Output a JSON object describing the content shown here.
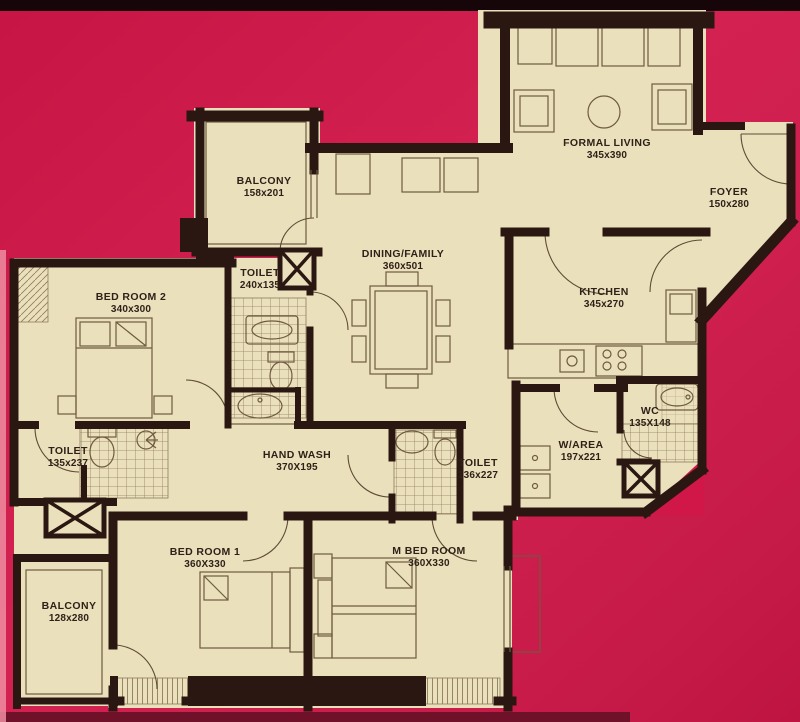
{
  "title": "apartment-floor-plan",
  "colors": {
    "background": "#d11648",
    "top_band": "#16060a",
    "bottom_band": "#6e1129",
    "left_edge_strip": "#ef8da1",
    "floor": "#ebe0bc",
    "wall": "#2a1711",
    "furniture_line": "#6e5b40",
    "label_text": "#2f2118"
  },
  "rooms": [
    {
      "id": "balcony-top",
      "name": "BALCONY",
      "dims": "158x201"
    },
    {
      "id": "formal-living",
      "name": "FORMAL LIVING",
      "dims": "345x390"
    },
    {
      "id": "foyer",
      "name": "FOYER",
      "dims": "150x280"
    },
    {
      "id": "dining-family",
      "name": "DINING/FAMILY",
      "dims": "360x501"
    },
    {
      "id": "kitchen",
      "name": "KITCHEN",
      "dims": "345x270"
    },
    {
      "id": "bed-room-2",
      "name": "BED ROOM 2",
      "dims": "340x300"
    },
    {
      "id": "toilet-top",
      "name": "TOILET",
      "dims": "240x135"
    },
    {
      "id": "toilet-left",
      "name": "TOILET",
      "dims": "135x237"
    },
    {
      "id": "hand-wash",
      "name": "HAND WASH",
      "dims": "370X195"
    },
    {
      "id": "toilet-mid",
      "name": "TOILET",
      "dims": "136x227"
    },
    {
      "id": "w-area",
      "name": "W/AREA",
      "dims": "197x221"
    },
    {
      "id": "wc",
      "name": "WC",
      "dims": "135X148"
    },
    {
      "id": "bed-room-1",
      "name": "BED ROOM 1",
      "dims": "360X330"
    },
    {
      "id": "m-bed-room",
      "name": "M BED ROOM",
      "dims": "360X330"
    },
    {
      "id": "balcony-bottom",
      "name": "BALCONY",
      "dims": "128x280"
    }
  ]
}
